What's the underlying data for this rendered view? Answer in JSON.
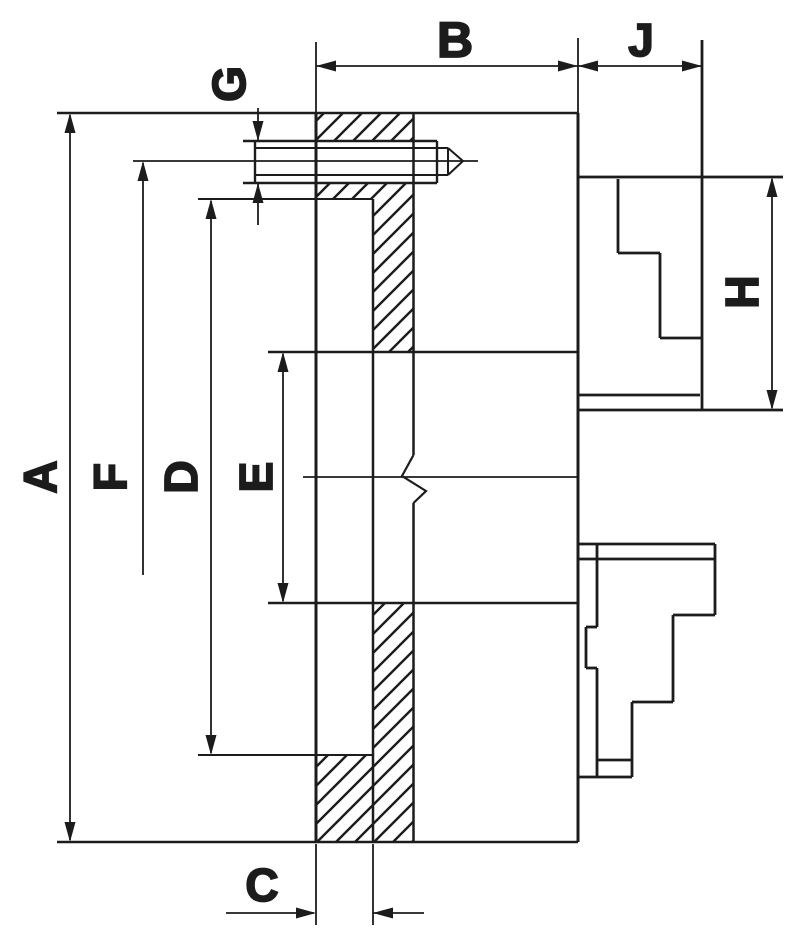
{
  "figure": {
    "background": "#ffffff",
    "line_color": "#1c1c1c"
  },
  "dimension_labels": {
    "A": "A",
    "B": "B",
    "C": "C",
    "D": "D",
    "E": "E",
    "F": "F",
    "G": "G",
    "H": "H",
    "J": "J"
  }
}
